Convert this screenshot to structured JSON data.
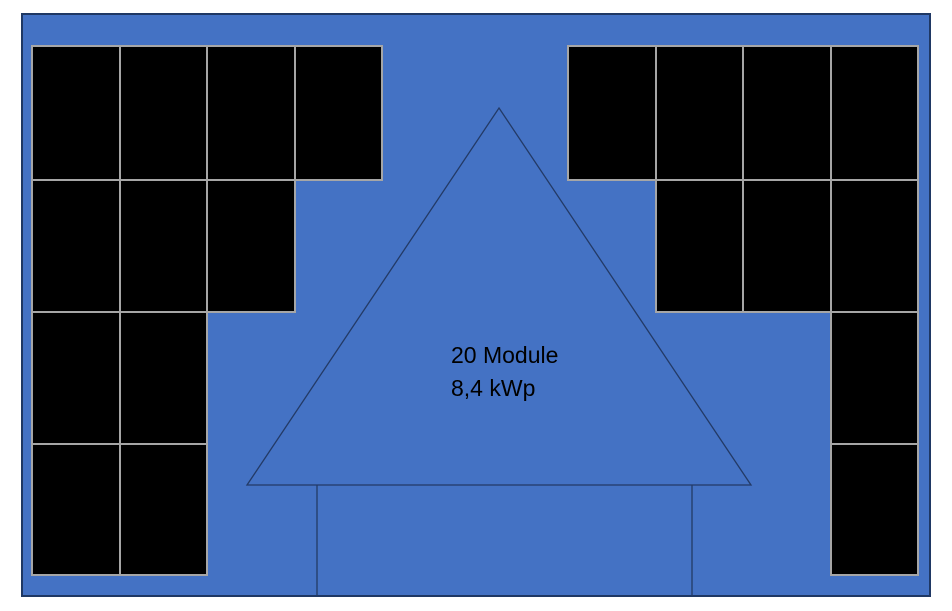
{
  "annotation": {
    "line1": "20 Module",
    "line2": "8,4 kWp",
    "text_color": "#000000"
  },
  "colors": {
    "page_background": "#ffffff",
    "roof_fill": "#4472c4",
    "roof_border": "#1f3864",
    "module_fill": "#000000",
    "module_border": "#a6a6a6",
    "outline_stroke": "#233a66"
  },
  "roof": {
    "x": 21,
    "y": 13,
    "width": 910,
    "height": 584
  },
  "modules": {
    "total": 20,
    "cell_width": 87.5,
    "row_tops": [
      45,
      179,
      311,
      443
    ],
    "row_heights": [
      134,
      132,
      132,
      131
    ],
    "left_group": {
      "align": "left",
      "origin_x": 31,
      "rows": [
        4,
        3,
        2,
        2
      ]
    },
    "right_group": {
      "align": "right",
      "edge_x": 917,
      "rows": [
        4,
        3,
        1,
        1
      ]
    }
  },
  "house": {
    "apex": [
      499,
      108
    ],
    "base_left": [
      247,
      485
    ],
    "base_right": [
      751,
      485
    ],
    "body_left_x": 317,
    "body_right_x": 692,
    "body_bottom_y": 596
  }
}
